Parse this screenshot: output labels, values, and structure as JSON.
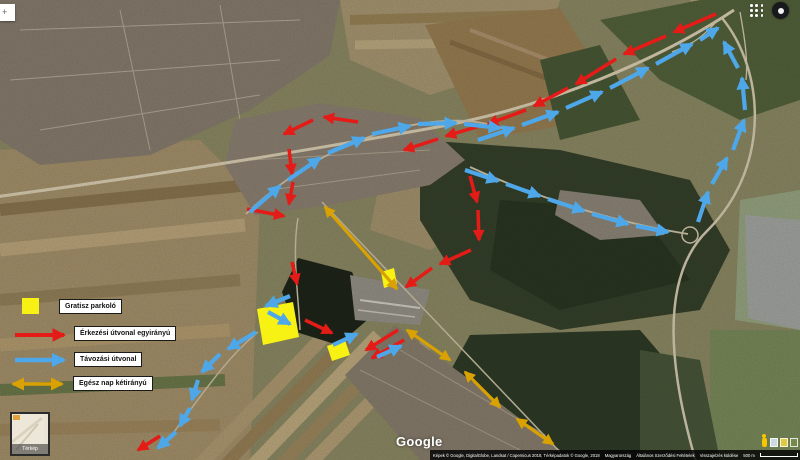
{
  "topbar": {
    "search_partial_glyph": "+",
    "apps_icon": "apps-grid-icon",
    "avatar_icon": "account-avatar"
  },
  "branding": {
    "logo": "Google"
  },
  "minimap": {
    "label": "Térkép"
  },
  "legend": {
    "items": [
      {
        "id": "parking",
        "symbol": "yellow-square",
        "label": "Gratisz parkoló"
      },
      {
        "id": "arrival",
        "symbol": "red-arrow",
        "label": "Érkezési útvonal egyirányú"
      },
      {
        "id": "departure",
        "symbol": "blue-arrow",
        "label": "Távozási útvonal"
      },
      {
        "id": "two_way",
        "symbol": "orange-double-arrow",
        "label": "Egész nap kétirányú"
      }
    ]
  },
  "attribution": {
    "imagery": "Képek © Google, DigitalGlobe, Landsat / Copernicus 2018, Térképadatok © Google, 2018",
    "country": "Magyarország",
    "terms": "Általános Szerződési Feltételek",
    "feedback": "Visszajelzés küldése",
    "scale_label": "500 m"
  },
  "overlay": {
    "colors": {
      "arrival": "#e41b17",
      "departure": "#4da7e8",
      "two_way": "#d9a102",
      "parking": "#f8f214"
    },
    "arrival_segments": [
      [
        716,
        14,
        674,
        32
      ],
      [
        666,
        36,
        624,
        54
      ],
      [
        616,
        59,
        576,
        84
      ],
      [
        568,
        88,
        534,
        106
      ],
      [
        526,
        110,
        488,
        124
      ],
      [
        480,
        126,
        446,
        136
      ],
      [
        438,
        139,
        404,
        150
      ],
      [
        358,
        122,
        324,
        117
      ],
      [
        313,
        120,
        284,
        134
      ],
      [
        289,
        149,
        292,
        174
      ],
      [
        293,
        182,
        289,
        204
      ],
      [
        247,
        209,
        284,
        216
      ],
      [
        470,
        176,
        477,
        202
      ],
      [
        478,
        210,
        479,
        240
      ],
      [
        471,
        250,
        440,
        264
      ],
      [
        432,
        268,
        406,
        287
      ],
      [
        398,
        330,
        366,
        350
      ],
      [
        404,
        340,
        372,
        358
      ],
      [
        305,
        320,
        332,
        333
      ],
      [
        292,
        262,
        297,
        284
      ],
      [
        160,
        436,
        138,
        450
      ]
    ],
    "departure_segments": [
      [
        250,
        212,
        280,
        186
      ],
      [
        288,
        180,
        320,
        158
      ],
      [
        328,
        153,
        364,
        138
      ],
      [
        372,
        134,
        410,
        126
      ],
      [
        418,
        124,
        456,
        123
      ],
      [
        464,
        124,
        500,
        128
      ],
      [
        465,
        170,
        498,
        181
      ],
      [
        506,
        184,
        540,
        196
      ],
      [
        548,
        199,
        584,
        211
      ],
      [
        592,
        214,
        628,
        224
      ],
      [
        636,
        226,
        668,
        232
      ],
      [
        698,
        222,
        708,
        192
      ],
      [
        712,
        184,
        727,
        158
      ],
      [
        733,
        150,
        744,
        120
      ],
      [
        745,
        110,
        742,
        78
      ],
      [
        738,
        68,
        724,
        42
      ],
      [
        478,
        140,
        514,
        128
      ],
      [
        522,
        125,
        558,
        112
      ],
      [
        566,
        108,
        602,
        92
      ],
      [
        610,
        88,
        648,
        68
      ],
      [
        656,
        64,
        692,
        44
      ],
      [
        700,
        40,
        718,
        28
      ],
      [
        256,
        332,
        228,
        349
      ],
      [
        220,
        354,
        202,
        372
      ],
      [
        198,
        380,
        192,
        400
      ],
      [
        190,
        408,
        180,
        426
      ],
      [
        176,
        432,
        158,
        448
      ],
      [
        333,
        345,
        357,
        334
      ],
      [
        377,
        357,
        401,
        346
      ],
      [
        290,
        296,
        266,
        306
      ],
      [
        268,
        312,
        290,
        324
      ]
    ],
    "two_way_segments": [
      [
        325,
        207,
        397,
        289
      ],
      [
        407,
        330,
        450,
        360
      ],
      [
        465,
        372,
        500,
        407
      ],
      [
        517,
        419,
        553,
        444
      ]
    ],
    "parking_polygons": [
      [
        [
          257,
          309
        ],
        [
          293,
          302
        ],
        [
          299,
          337
        ],
        [
          263,
          345
        ]
      ],
      [
        [
          327,
          346
        ],
        [
          345,
          340
        ],
        [
          350,
          355
        ],
        [
          332,
          361
        ]
      ],
      [
        [
          381,
          272
        ],
        [
          394,
          268
        ],
        [
          397,
          284
        ],
        [
          384,
          288
        ]
      ]
    ]
  }
}
